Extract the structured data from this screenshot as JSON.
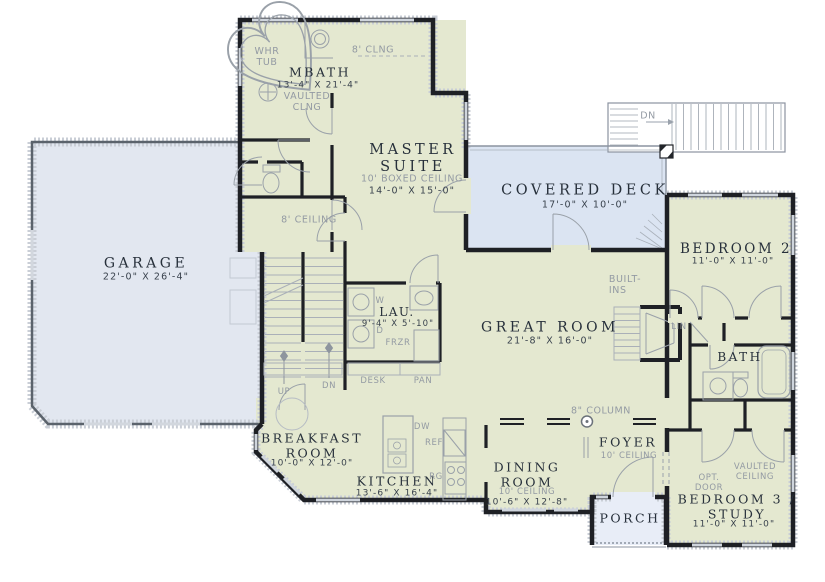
{
  "title": "First floor plan",
  "colors": {
    "interior": "#e4e8d0",
    "garage_fill": "#e2e7f0",
    "deck_fill": "#dbe4f2",
    "porch_fill": "#e8edf7",
    "wall": "#1e2025",
    "garage_wall": "#5b636c",
    "fixture_line": "#9aa1a9",
    "window_line": "#cfd5dd",
    "room_name_text": "#27303b",
    "note_text": "#939aa3"
  },
  "labels": {
    "whr_tub_1": "WHR",
    "whr_tub_2": "TUB",
    "mbath_name": "MBATH",
    "mbath_dims": "13'-4\" X 21'-4\"",
    "vaulted_clng_1": "VAULTED",
    "vaulted_clng_2": "CLNG",
    "clng8": "8' CLNG",
    "master_1": "MASTER",
    "master_2": "SUITE",
    "master_note": "10' BOXED CEILING",
    "master_dims": "14'-0\" X 15'-0\"",
    "ceiling8": "8' CEILING",
    "deck_name": "COVERED DECK",
    "deck_dims": "17'-0\" X 10'-0\"",
    "deck_dn": "DN",
    "bed2_name": "BEDROOM 2",
    "bed2_dims": "11'-0\" X 11'-0\"",
    "garage_name": "GARAGE",
    "garage_dims": "22'-0\" X 26'-4\"",
    "great_name": "GREAT ROOM",
    "great_dims": "21'-8\" X 16'-0\"",
    "builtins_1": "BUILT-",
    "builtins_2": "INS",
    "lau_name": "LAU.",
    "lau_dims": "9'-4\" X 5'-10\"",
    "w": "W",
    "d": "D",
    "frzr": "FRZR",
    "up": "UP",
    "dn": "DN",
    "desk": "DESK",
    "pan": "PAN",
    "lin": "LIN",
    "bath_name": "BATH",
    "breakfast_1": "BREAKFAST",
    "breakfast_2": "ROOM",
    "breakfast_dims": "10'-0\" X 12'-0\"",
    "kitchen_name": "KITCHEN",
    "kitchen_dims": "13'-6\" X 16'-4\"",
    "dw": "DW",
    "ref": "REF",
    "rg": "RG",
    "column8": "8\" COLUMN",
    "foyer_name": "FOYER",
    "foyer_note": "10' CEILING",
    "dining_1": "DINING",
    "dining_2": "ROOM",
    "dining_note": "10' CEILING",
    "dining_dims": "10'-6\" X 12'-8\"",
    "porch_name": "PORCH",
    "optdoor_1": "OPT.",
    "optdoor_2": "DOOR",
    "vaulted2_1": "VAULTED",
    "vaulted2_2": "CEILING",
    "bed3_1": "BEDROOM 3 /",
    "bed3_2": "STUDY",
    "bed3_dims": "11'-0\" X 11'-0\""
  }
}
